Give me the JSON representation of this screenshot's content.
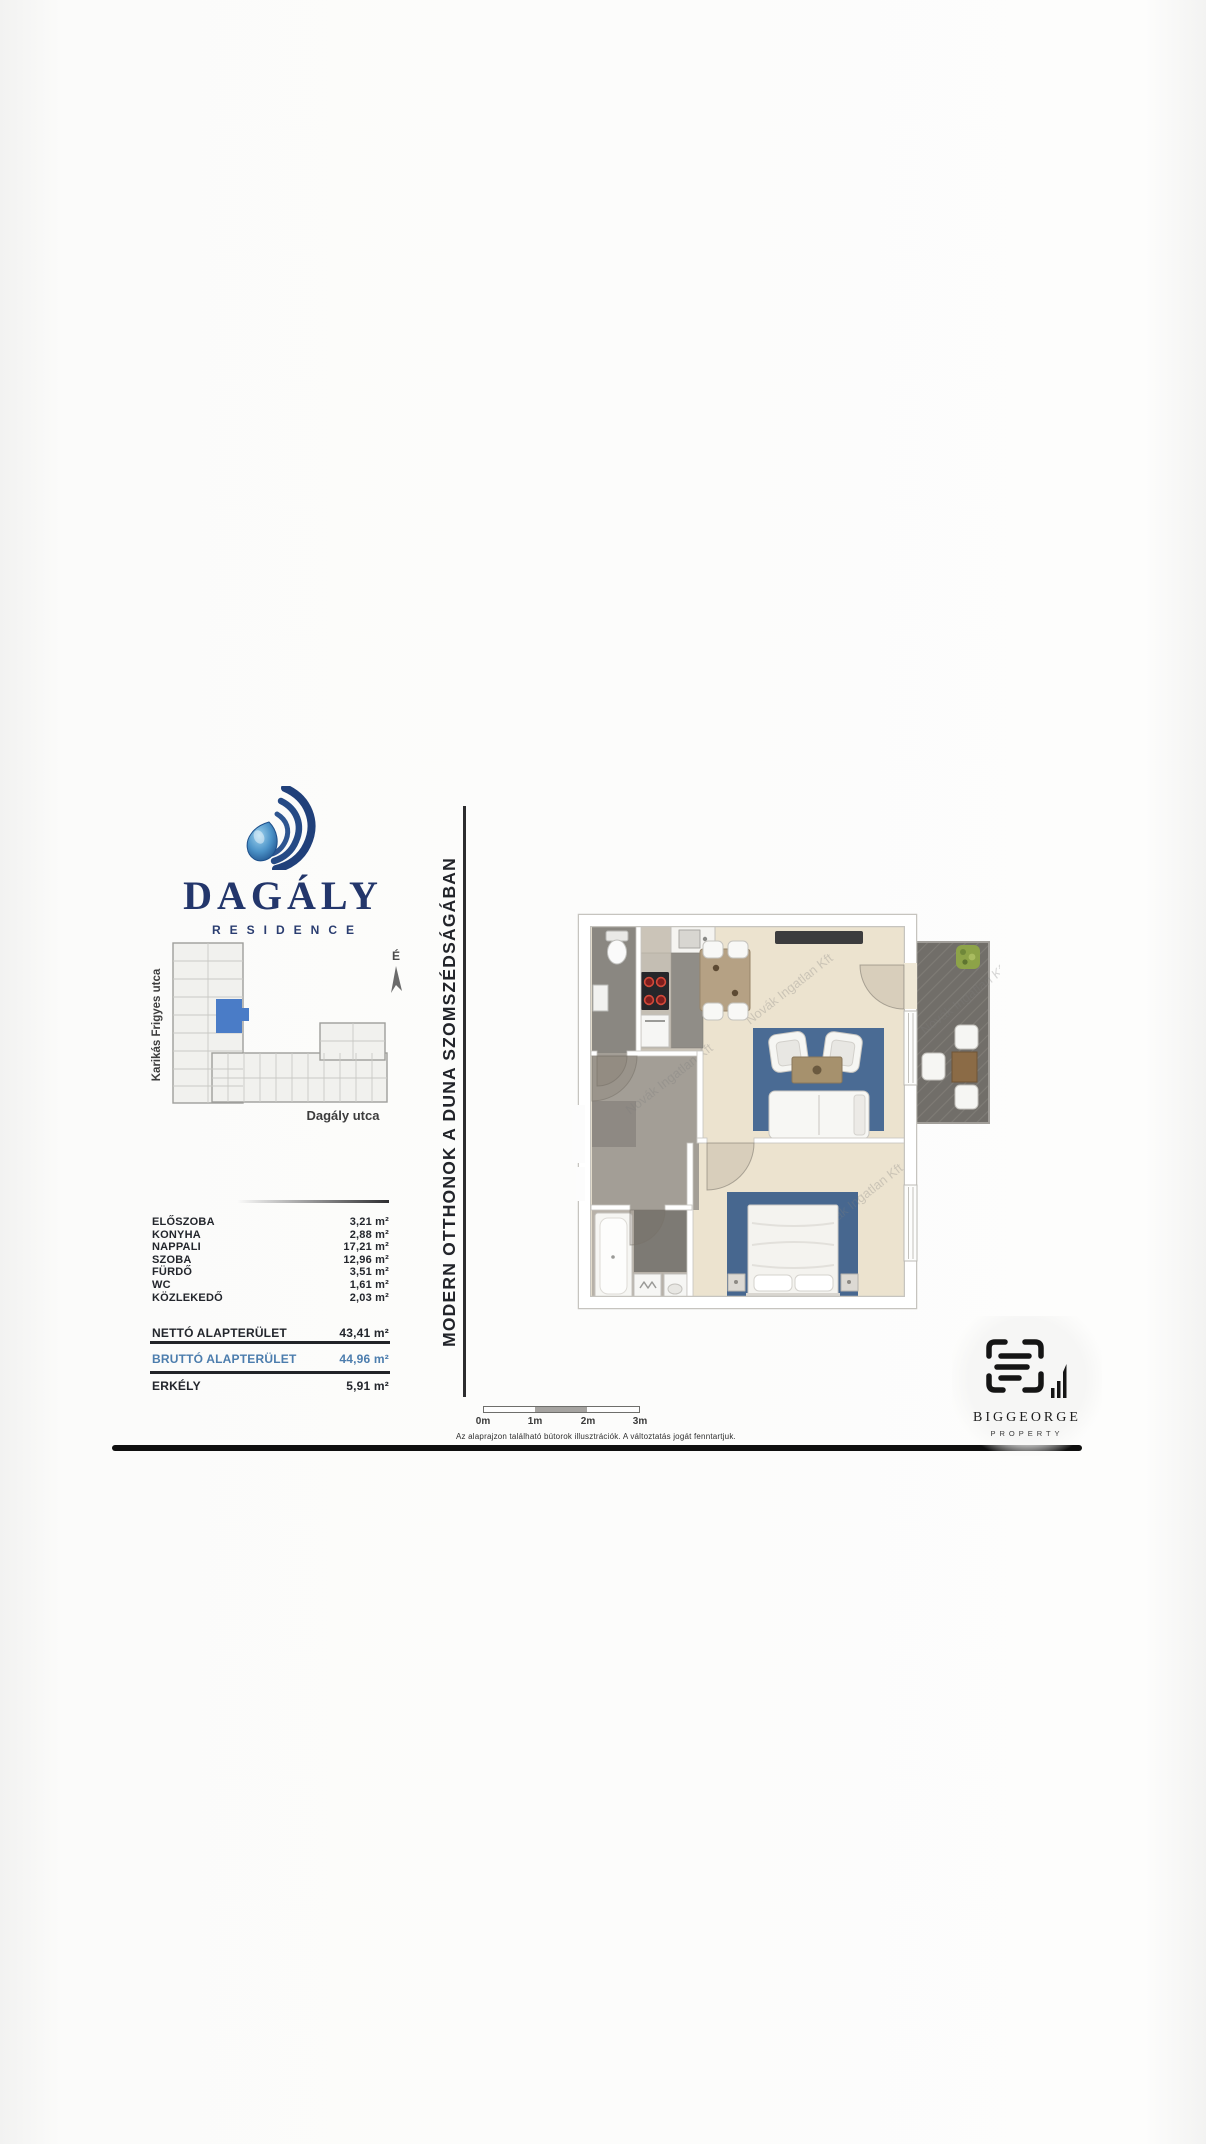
{
  "brand": {
    "name": "DAGÁLY",
    "subtitle": "RESIDENCE",
    "navy": "#23366b",
    "drop_blue": "#3f7fb6"
  },
  "site_plan": {
    "street_left": "Karikás Frigyes utca",
    "street_bottom": "Dagály utca",
    "north_label": "É",
    "highlight_color": "#4a7cc7"
  },
  "tagline": "MODERN OTTHONOK A DUNA SZOMSZÉDSÁGÁBAN",
  "area_table": {
    "rows": [
      {
        "label": "ELŐSZOBA",
        "value": "3,21 m²"
      },
      {
        "label": "KONYHA",
        "value": "2,88 m²"
      },
      {
        "label": "NAPPALI",
        "value": "17,21 m²"
      },
      {
        "label": "SZOBA",
        "value": "12,96 m²"
      },
      {
        "label": "FÜRDŐ",
        "value": "3,51 m²"
      },
      {
        "label": "WC",
        "value": "1,61 m²"
      },
      {
        "label": "KÖZLEKEDŐ",
        "value": "2,03 m²"
      }
    ],
    "netto": {
      "label": "NETTÓ ALAPTERÜLET",
      "value": "43,41 m²"
    },
    "brutto": {
      "label": "BRUTTÓ ALAPTERÜLET",
      "value": "44,96 m²",
      "color": "#4c7dad"
    },
    "erkely": {
      "label": "ERKÉLY",
      "value": "5,91 m²"
    }
  },
  "scale_bar": {
    "labels": [
      "0m",
      "1m",
      "2m",
      "3m"
    ]
  },
  "disclaimer": "Az alaprajzon található bútorok illusztrációk. A változtatás jogát fenntartjuk.",
  "watermark": "Novák Ingatlan Kft",
  "footer_logo": {
    "name": "BIGGEORGE",
    "subtitle": "PROPERTY"
  },
  "colors": {
    "rug_blue": "#4a6b94",
    "plan_beige": "#ece3cf",
    "balcony_gray": "#716e69",
    "footer_line": "#0f0f0f"
  }
}
